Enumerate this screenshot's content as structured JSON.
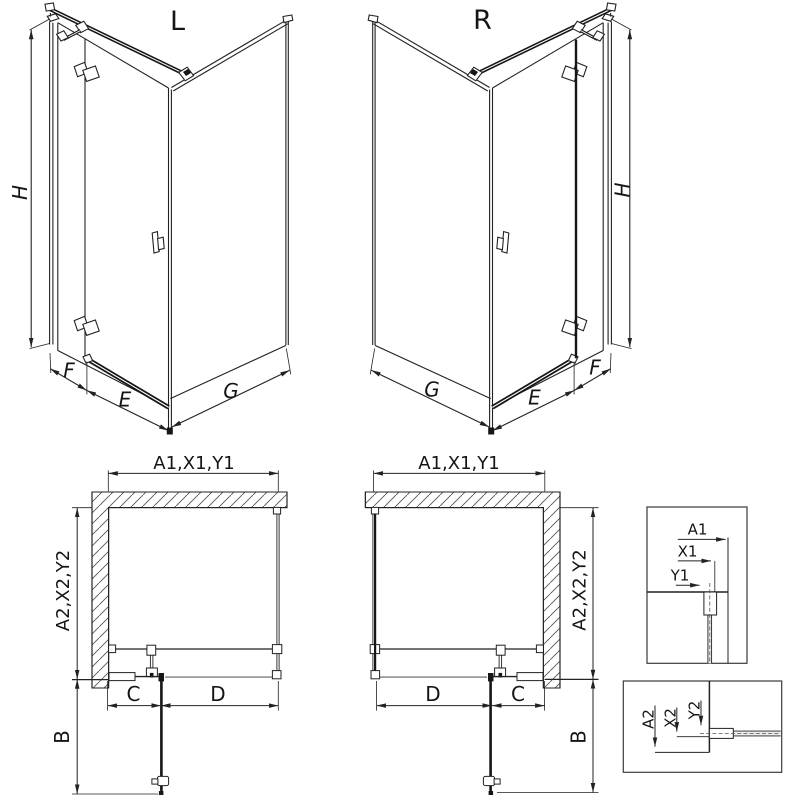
{
  "drawing": {
    "type": "shower-enclosure-technical-drawing",
    "colors": {
      "line": "#222222",
      "dark": "#161616",
      "background": "#ffffff",
      "hatch": "#555555"
    }
  },
  "perspective_left": {
    "variant": "L",
    "dim_height": "H",
    "dim_fixed_panel": "F",
    "dim_door": "E",
    "dim_side_panel": "G"
  },
  "perspective_right": {
    "variant": "R",
    "dim_height": "H",
    "dim_fixed_panel": "F",
    "dim_door": "E",
    "dim_side_panel": "G"
  },
  "plan_left": {
    "dim_width_top": "A1,X1,Y1",
    "dim_depth": "A2,X2,Y2",
    "dim_fixed": "C",
    "dim_door": "D",
    "dim_entry": "B"
  },
  "plan_right": {
    "dim_width_top": "A1,X1,Y1",
    "dim_depth": "A2,X2,Y2",
    "dim_door": "D",
    "dim_fixed": "C",
    "dim_entry": "B"
  },
  "detail_top": {
    "dim_a1": "A1",
    "dim_x1": "X1",
    "dim_y1": "Y1"
  },
  "detail_bottom": {
    "dim_a2": "A2",
    "dim_x2": "X2",
    "dim_y2": "Y2"
  }
}
